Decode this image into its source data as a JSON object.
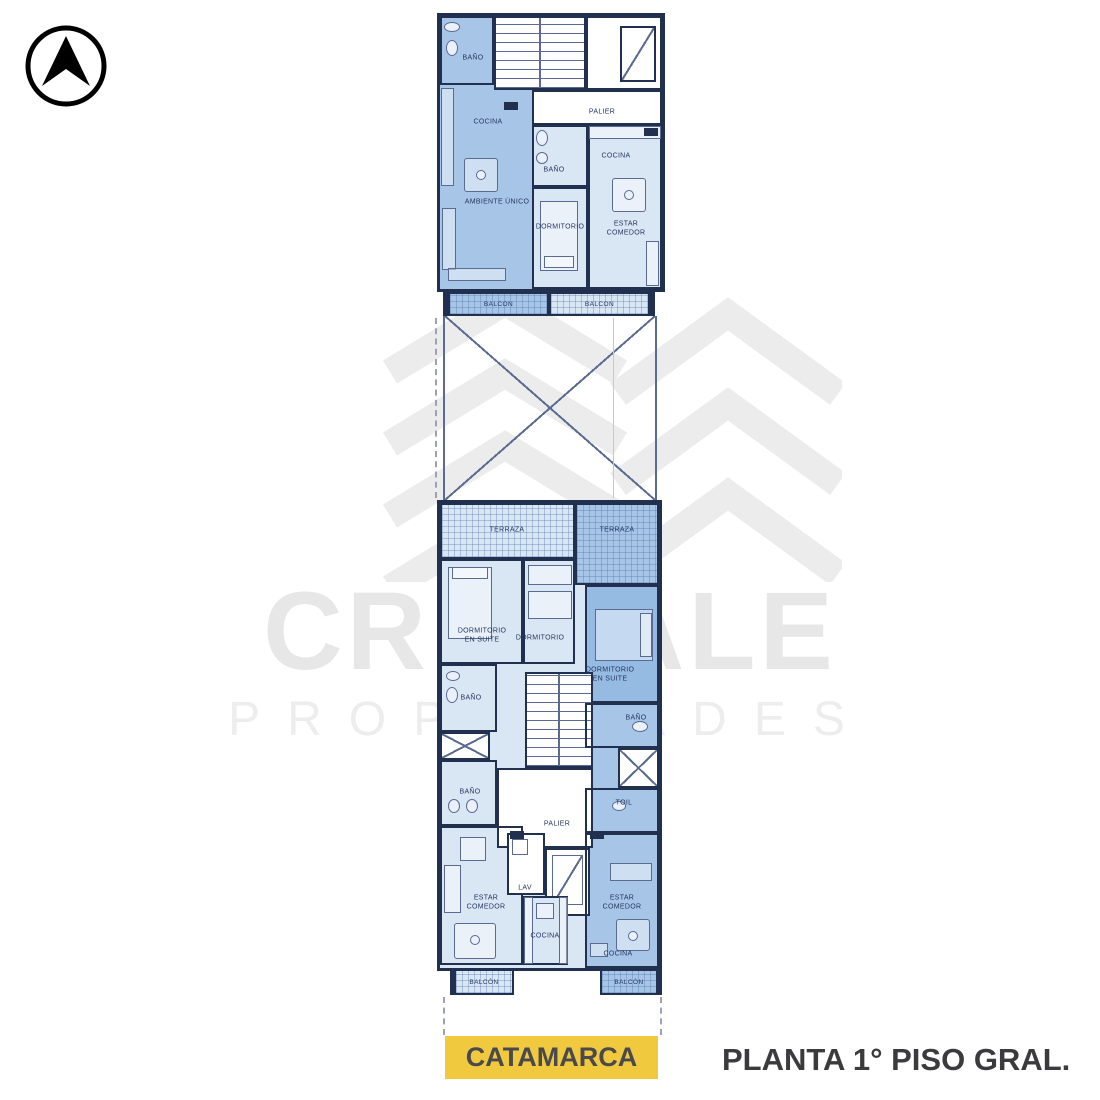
{
  "icons": {
    "compass": "north-arrow-icon",
    "brand_logo": "chevron-building-logo"
  },
  "watermark": {
    "brand": "CRISTALE",
    "subbrand": "PROPIEDADES"
  },
  "colors": {
    "unit_light": "#d9e6f4",
    "unit_medium": "#a7c5e7",
    "unit_dark": "#96bbe3",
    "wall": "#22304f",
    "line": "#5a6a90",
    "hatch": "#4a6ea855",
    "label": "#253561",
    "badge_bg": "#f0c93f",
    "text_dark": "#3b3b3d",
    "wm": "#e7e7e7",
    "wm2": "#ededed"
  },
  "top_plan": {
    "rooms": [
      {
        "label": "BAÑO"
      },
      {
        "label": "COCINA"
      },
      {
        "label": "AMBIENTE ÚNICO"
      },
      {
        "label": "PALIER"
      },
      {
        "label": "COCINA"
      },
      {
        "label": "BAÑO"
      },
      {
        "label": "DORMITORIO"
      },
      {
        "label": "ESTAR COMEDOR"
      },
      {
        "label": "BALCON"
      },
      {
        "label": "BALCON"
      }
    ]
  },
  "bottom_plan": {
    "rooms": [
      {
        "label": "TERRAZA"
      },
      {
        "label": "TERRAZA"
      },
      {
        "label": "DORMITORIO EN SUITE"
      },
      {
        "label": "DORMITORIO"
      },
      {
        "label": "DORMITORIO EN SUITE"
      },
      {
        "label": "BAÑO"
      },
      {
        "label": "BAÑO"
      },
      {
        "label": "BAÑO"
      },
      {
        "label": "TOIL"
      },
      {
        "label": "PALIER"
      },
      {
        "label": "ESTAR COMEDOR"
      },
      {
        "label": "LAV"
      },
      {
        "label": "COCINA"
      },
      {
        "label": "ESTAR COMEDOR"
      },
      {
        "label": "COCINA"
      },
      {
        "label": "BALCÓN"
      },
      {
        "label": "BALCÓN"
      }
    ]
  },
  "footer": {
    "street": "CATAMARCA",
    "title": "PLANTA 1° PISO GRAL."
  }
}
